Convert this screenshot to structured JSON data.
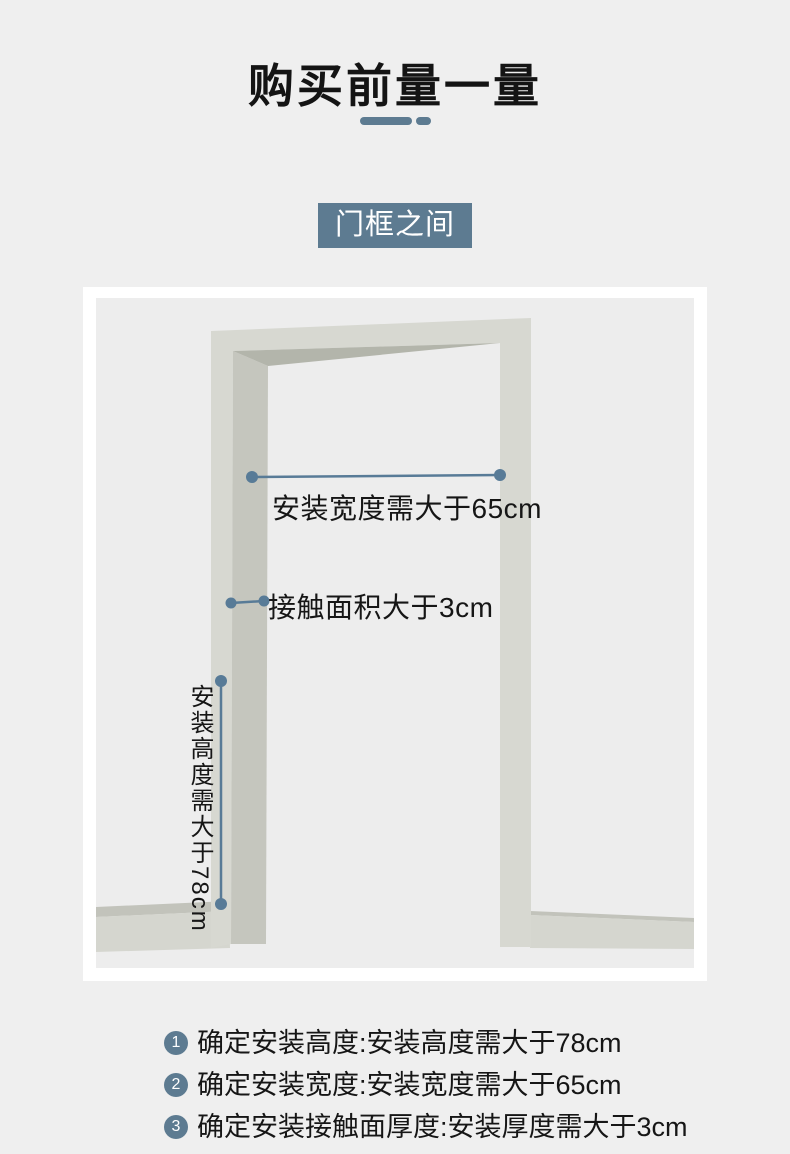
{
  "theme": {
    "page-bg": "#efefef",
    "card-bg": "#ffffff",
    "panel-bg": "#ededed",
    "accent": "#5d7b91",
    "line-color": "#587b97",
    "text-color": "#141414",
    "frame-light": "#d7d8d1",
    "frame-side": "#c5c6be",
    "frame-under": "#b3b5ab",
    "baseboard-top": "#c2c3bb",
    "baseboard-front": "#d5d6cf"
  },
  "header": {
    "title": "购买前量一量"
  },
  "section_label": {
    "text": "门框之间"
  },
  "diagram": {
    "width_label": "安装宽度需大于65cm",
    "contact_label": "接触面积大于3cm",
    "height_label": "安装高度需大于78cm"
  },
  "steps": [
    {
      "num": "1",
      "text": "确定安装高度:安装高度需大于78cm"
    },
    {
      "num": "2",
      "text": "确定安装宽度:安装宽度需大于65cm"
    },
    {
      "num": "3",
      "text": "确定安装接触面厚度:安装厚度需大于3cm"
    }
  ]
}
